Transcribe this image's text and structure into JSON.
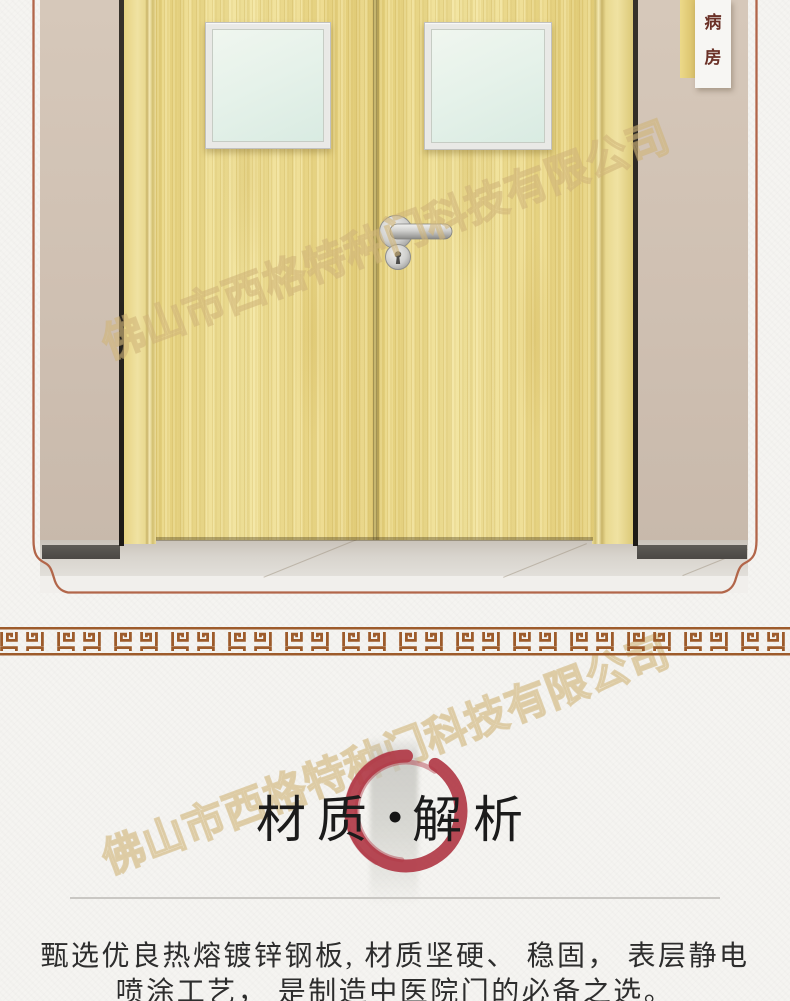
{
  "photo": {
    "sign": {
      "chars": [
        "病",
        "房"
      ]
    }
  },
  "watermark": {
    "text": "佛山市西格特种门科技有限公司"
  },
  "material_section": {
    "title_left": "材质",
    "separator": "•",
    "title_right": "解析",
    "body_line1": "甄选优良热熔镀锌钢板, 材质坚硬、 稳固， 表层静电",
    "body_line2": "喷涂工艺， 是制造中医院门的必备之选。"
  },
  "colors": {
    "accent_red": "#b13a47",
    "frame_line": "#b2664a",
    "meander_brown": "#9d5b2b",
    "door_wood": "#ecd98a",
    "wall_tan": "#cfc0b2",
    "sign_text": "#6b3127"
  }
}
